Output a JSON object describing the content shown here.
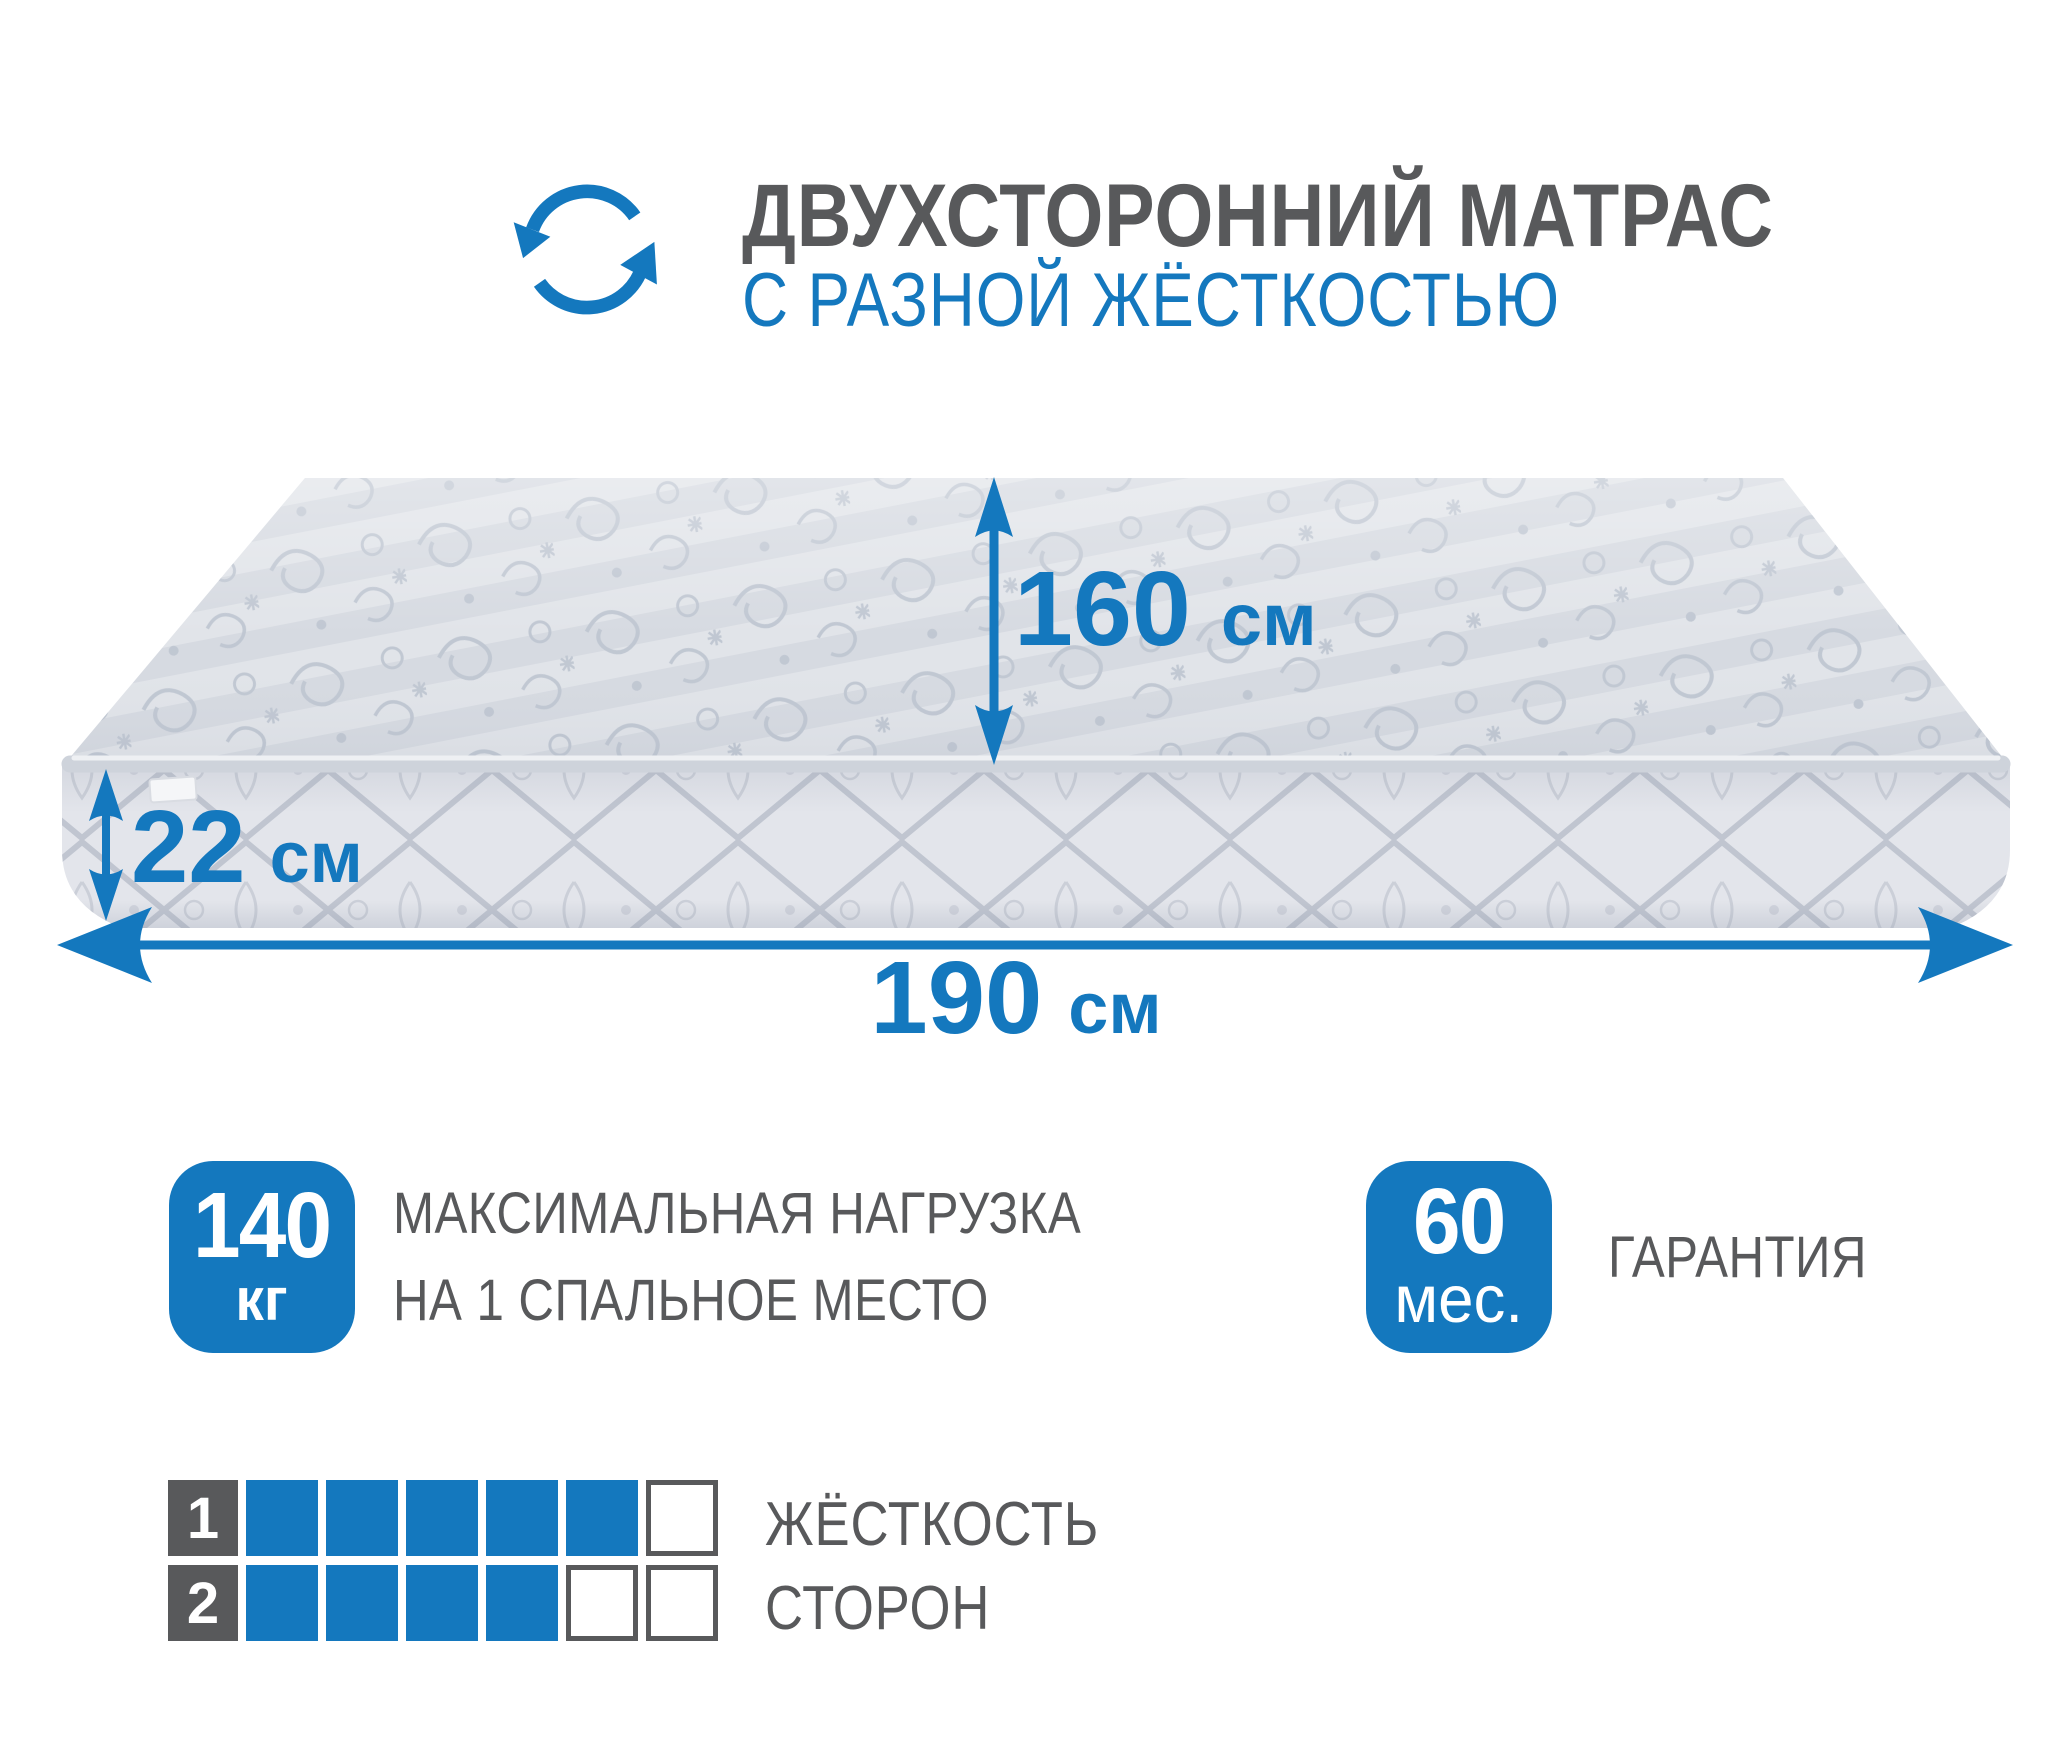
{
  "header": {
    "title": "ДВУХСТОРОННИЙ МАТРАС",
    "subtitle": "С РАЗНОЙ ЖЁСТКОСТЬЮ",
    "icon": "rotate-icon"
  },
  "dimensions": {
    "width": {
      "value": "160",
      "unit": "см"
    },
    "height": {
      "value": "22",
      "unit": "см"
    },
    "length": {
      "value": "190",
      "unit": "см"
    }
  },
  "features": {
    "max_load": {
      "value": "140",
      "unit": "кг",
      "label_line1": "МАКСИМАЛЬНАЯ НАГРУЗКА",
      "label_line2": "НА 1 СПАЛЬНОЕ МЕСТО"
    },
    "warranty": {
      "value": "60",
      "unit": "мес.",
      "label": "ГАРАНТИЯ"
    }
  },
  "firmness": {
    "label_line1": "ЖЁСТКОСТЬ",
    "label_line2": "СТОРОН",
    "scale_max": 6,
    "sides": [
      {
        "index": "1",
        "filled": 5
      },
      {
        "index": "2",
        "filled": 4
      }
    ]
  },
  "colors": {
    "accent": "#1478be",
    "text_gray": "#58595b",
    "badge_text": "#ffffff",
    "square_gray": "#58595b",
    "mat_top": "#d6dae1",
    "mat_top_pattern": "#c0c7d2",
    "mat_side": "#e3e5eb",
    "mat_side_pattern": "#b4bac6",
    "mat_pipe": "#ced3db",
    "tag": "#f5f6f8"
  }
}
